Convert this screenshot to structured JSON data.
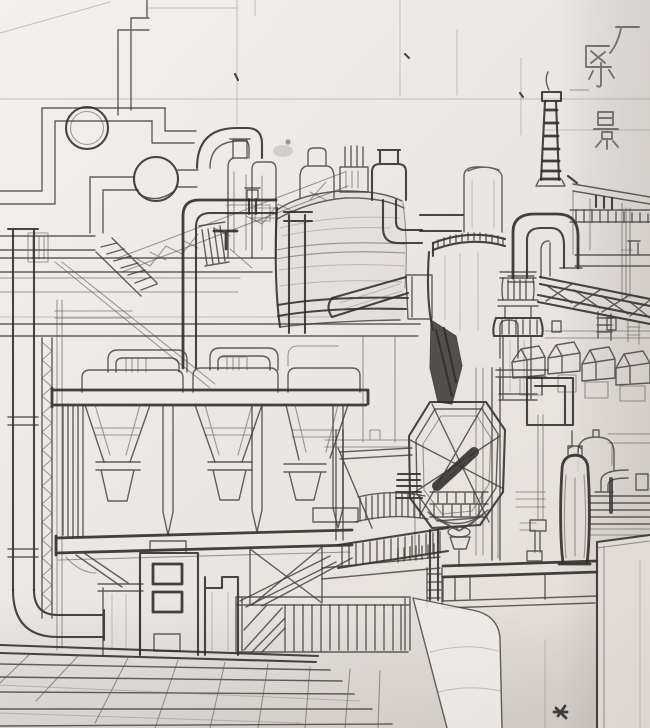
{
  "artwork": {
    "type": "hand-drawn pencil sketch on creased paper",
    "caption": {
      "text": "厂区小景",
      "chars": [
        "厂",
        "区",
        "小",
        "景"
      ],
      "orientation": "vertical-top-right"
    },
    "scene": {
      "subject": "industrial factory area",
      "elements": [
        "pipe run with ring loop",
        "spherical tank on pipe",
        "twin cylindrical towers",
        "large horizontal vessel",
        "elbow duct",
        "bank of four hoppers on platform",
        "zig-zag ladder cage",
        "scrubber tower with castellated rim",
        "octagonal feeder with cross bracing",
        "chimney with ladder rungs",
        "U-turn duct",
        "ribbed duct column",
        "truss conveyor bridge",
        "row of peaked bucket bins",
        "dark bottle tank",
        "dome-top tank",
        "stairs and railings",
        "concrete blocks with windows",
        "tiled floor",
        "tilted slab panel",
        "right wall"
      ]
    }
  },
  "palette": {
    "paper": "#ebe8e2",
    "paper_highlight": "#f3f1ec",
    "paper_shadow": "#d9d4cb",
    "pencil_dark": "#2f2d2a",
    "pencil_mid": "#3f3c37",
    "pencil_soft": "#56524b",
    "pencil_faint": "#6e6a62"
  }
}
